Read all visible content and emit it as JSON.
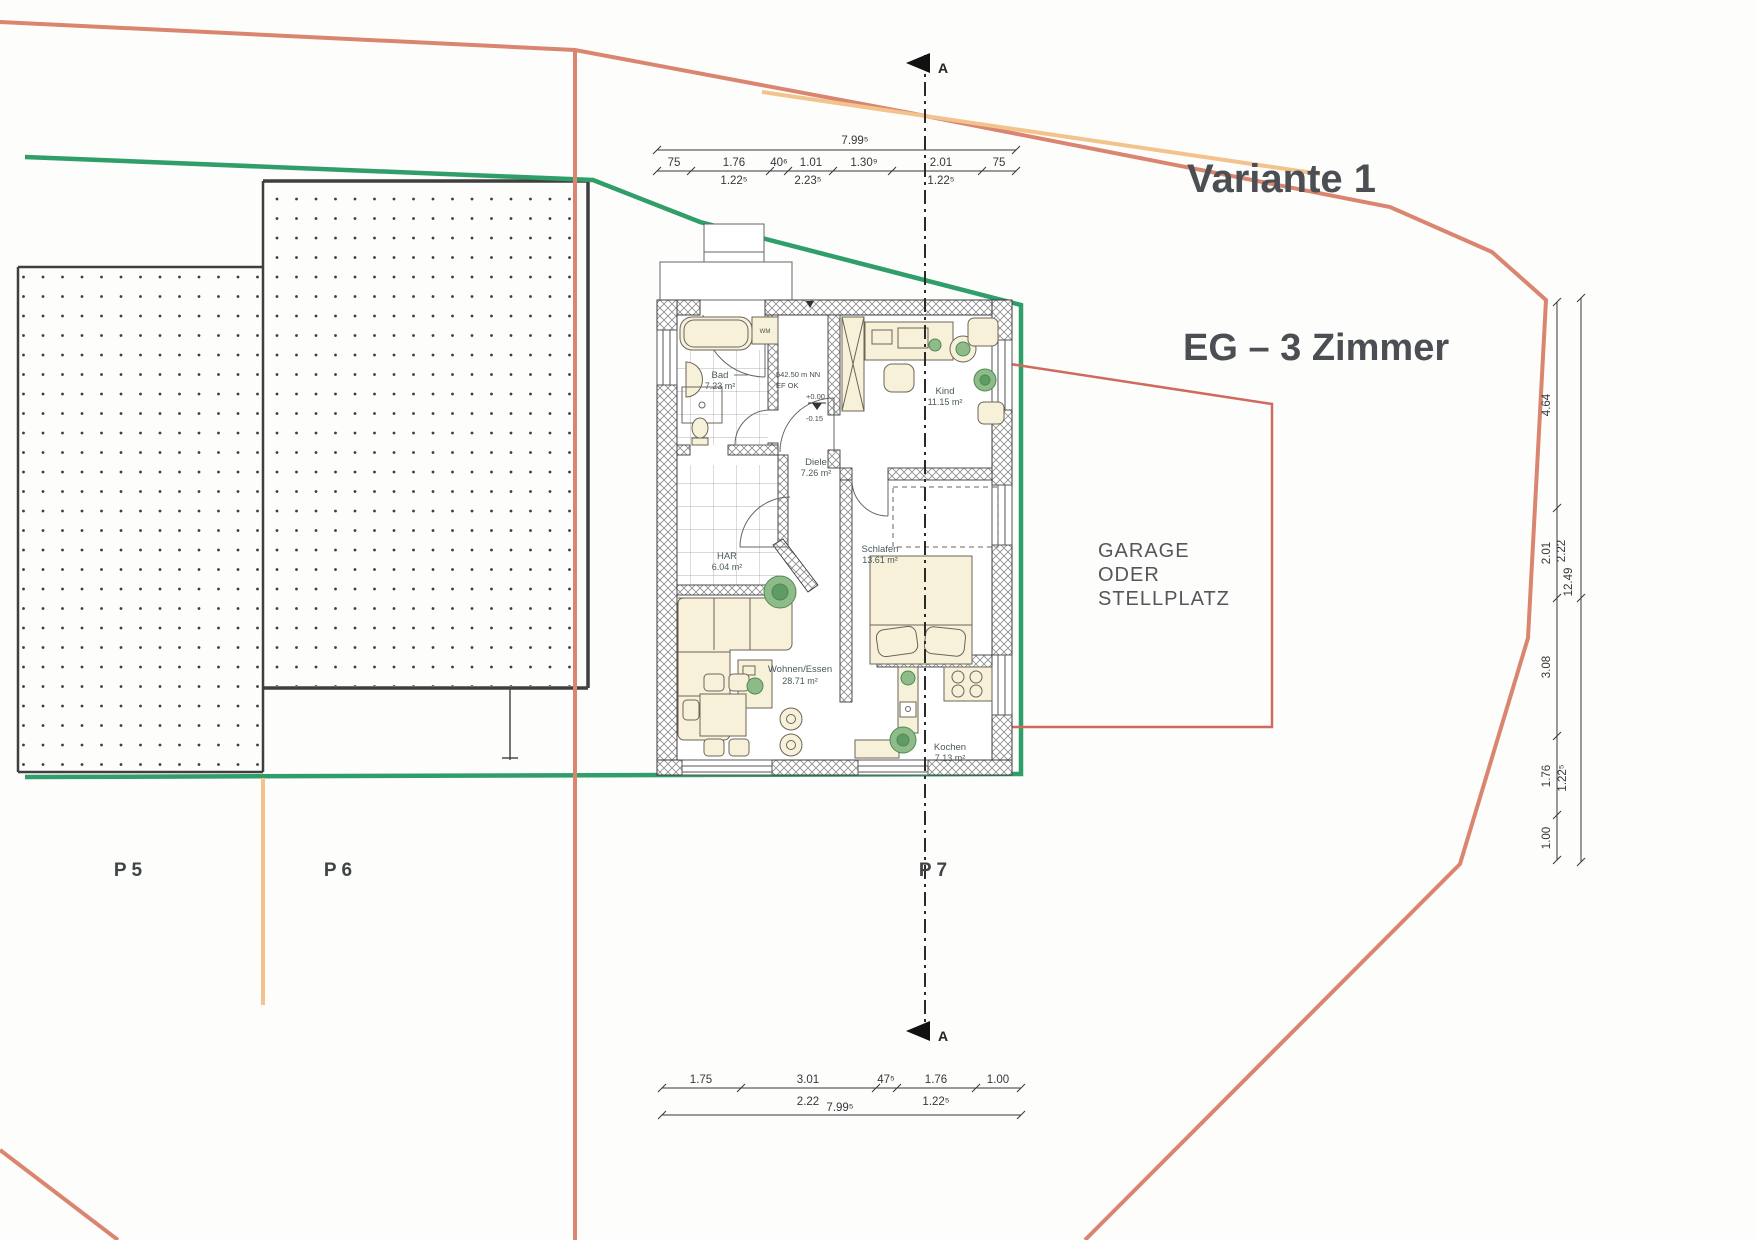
{
  "titles": {
    "variant": "Variante 1",
    "floor": "EG – 3 Zimmer"
  },
  "site": {
    "parcels": [
      {
        "label": "P 5"
      },
      {
        "label": "P 6"
      },
      {
        "label": "P 7"
      }
    ],
    "garage_note": {
      "line1": "GARAGE",
      "line2": "ODER",
      "line3": "STELLPLATZ"
    },
    "section_marker": "A"
  },
  "rooms": [
    {
      "name": "Bad",
      "area": "7.23 m²"
    },
    {
      "name": "Diele",
      "area": "7.26 m²"
    },
    {
      "name": "Kind",
      "area": "11.15 m²"
    },
    {
      "name": "Schlafen",
      "area": "13.61 m²"
    },
    {
      "name": "HAR",
      "area": "6.04 m²"
    },
    {
      "name": "Wohnen/Essen",
      "area": "28.71 m²"
    },
    {
      "name": "Kochen",
      "area": "7.13 m²"
    }
  ],
  "fixtures": {
    "washing_machine": "WM"
  },
  "level_note": {
    "altitude": "542.50 m NN",
    "ref": "EF OK",
    "upper": "+0.00",
    "lower": "-0.15"
  },
  "dimensions": {
    "top": {
      "total": "7.99⁵",
      "segments": [
        "75",
        "1.76",
        "40⁶",
        "1.01",
        "1.30⁹",
        "2.01",
        "75"
      ],
      "sub": [
        "1.22⁵",
        "2.23⁵",
        "1.22⁵"
      ]
    },
    "bottom": {
      "total": "7.99⁵",
      "segments": [
        "1.75",
        "3.01",
        "47⁵",
        "1.76",
        "1.00"
      ],
      "sub": [
        "2.22",
        "1.22⁵"
      ]
    },
    "right": {
      "segments": [
        "4.64",
        "2.01",
        "3.08",
        "1.76",
        "1.00"
      ],
      "sub": [
        "1.22⁵"
      ],
      "outer": [
        "2.22",
        "12.49"
      ]
    }
  },
  "colors": {
    "boundary_red": "#d98570",
    "boundary_yellow": "#f2c38c",
    "boundary_green": "#2f9e68",
    "garage_red": "#cf6a5f",
    "ink": "#3a3e41",
    "label": "#4a585c"
  }
}
